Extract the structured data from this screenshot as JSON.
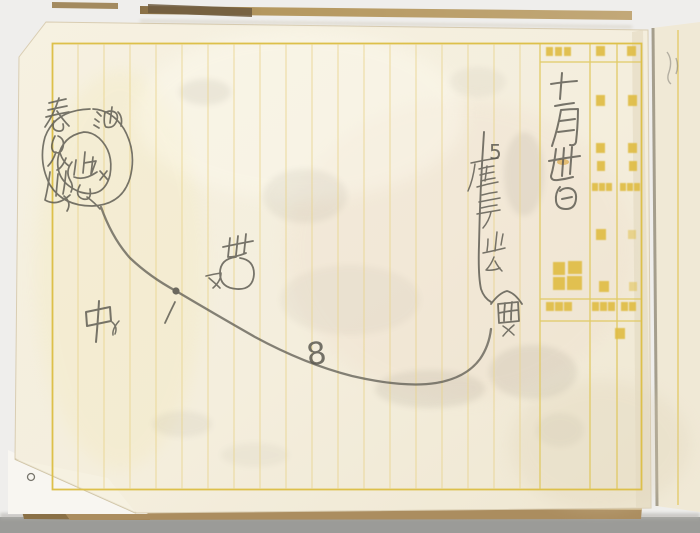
{
  "notebook": {
    "handwriting": {
      "date_vertical": "十一月丗日",
      "numbers": {
        "curve": "8",
        "note": "5"
      },
      "note_vertical": "5厘ニテ止ム",
      "mountain_label_vertical": "春見山",
      "circle_top_label": "油",
      "inside_circle_label": "山",
      "center_label": "中",
      "small_marks": [
        "×",
        "ㄨ",
        "ヌ",
        "1"
      ],
      "flag_glyph": "世",
      "terminus_glyph": "金",
      "corner_mark": "o"
    },
    "printed_form": {
      "ink": "#e0bd45",
      "large_label": "殿",
      "header_cells": [
        "受信局",
        "第",
        "號"
      ],
      "date_cells": [
        "月",
        "日"
      ],
      "meridiem_cells": [
        "午前",
        "午後"
      ],
      "station_cells": [
        "發信局",
        "着信局"
      ],
      "time_cells": [
        "時",
        "分"
      ],
      "bottom_cells": [
        "受信者",
        "配達人"
      ],
      "tally_label": "次"
    },
    "colors": {
      "background": "#eeedea",
      "desk_shadow": "#9b9b98",
      "page": "#f4eedd",
      "underpage": "#f8f6f1",
      "next_page": "#f0e9d6",
      "cover_edge": "#a98a5c",
      "frame_yellow": "#ddc04a",
      "rule_yellow": "#e7d28a",
      "pencil": "#5b5950"
    }
  }
}
